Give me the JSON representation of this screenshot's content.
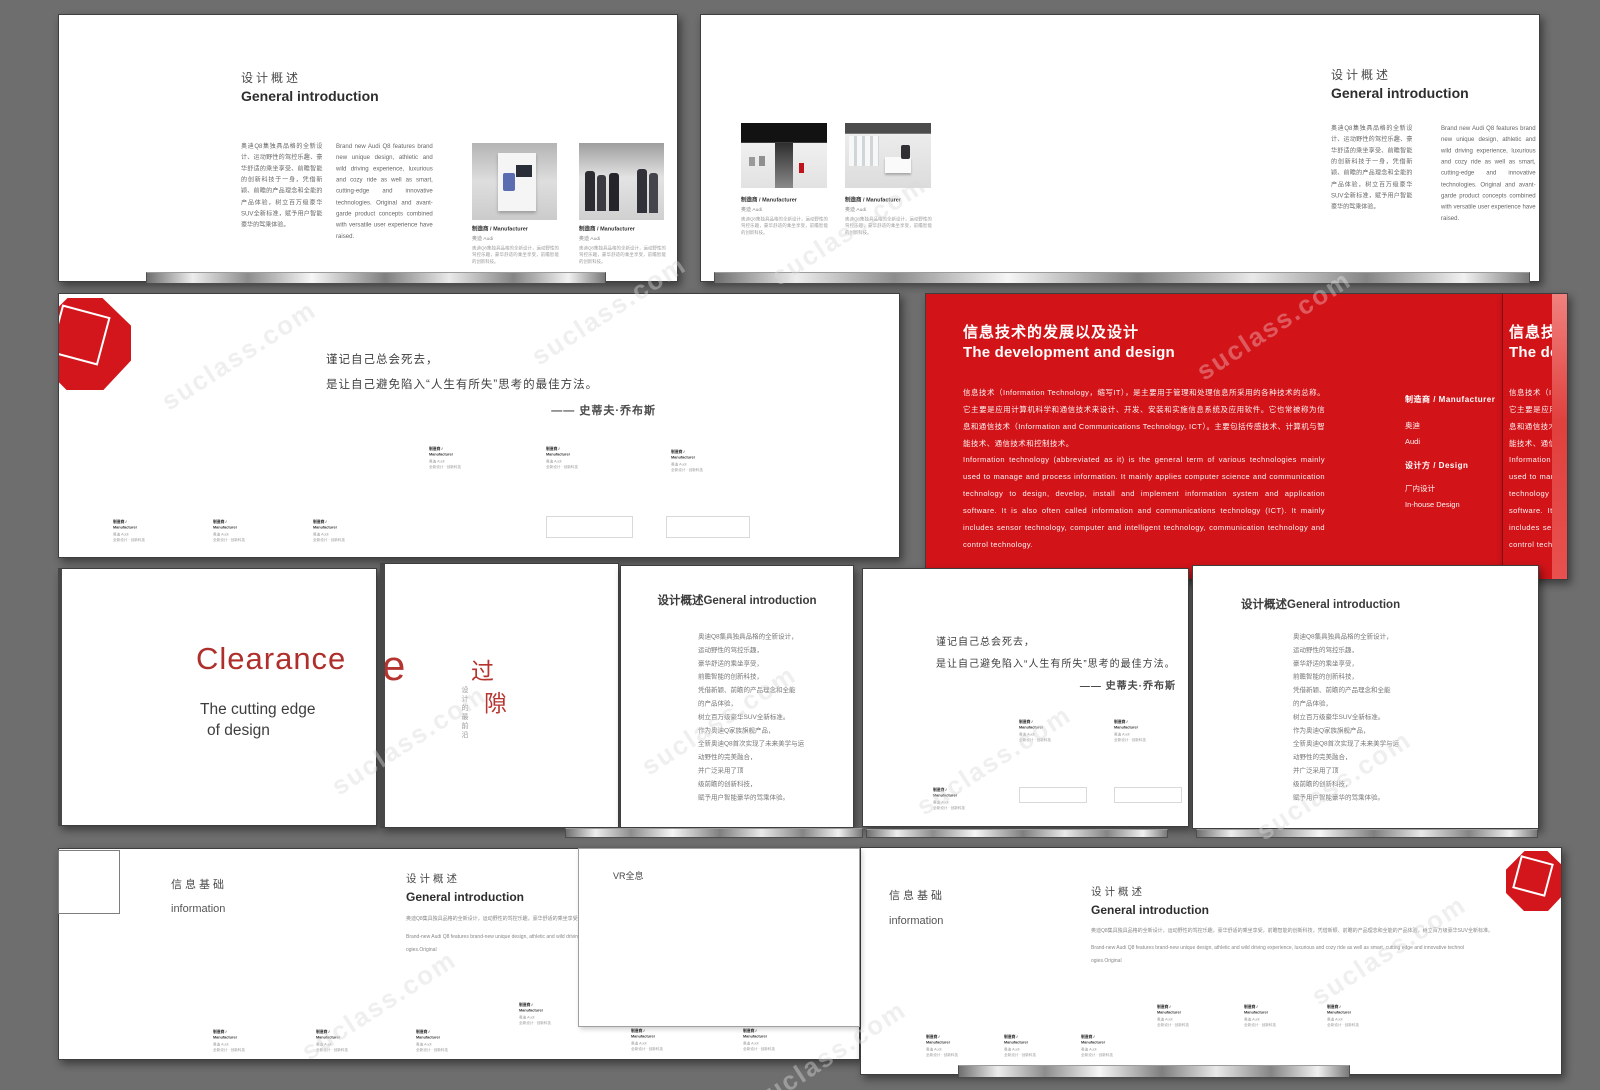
{
  "watermark": {
    "text": "suclass.com"
  },
  "colors": {
    "background": "#6e6e6e",
    "red": "#d21419",
    "cover_red": "#ae2f2b"
  },
  "shared": {
    "overview_zh": "设计概述",
    "overview_en": "General introduction",
    "info_zh": "信息基础",
    "info_en": "information",
    "quote": {
      "line1": "谨记自己总会死去，",
      "line2": "是让自己避免陷入“人生有所失”思考的最佳方法。",
      "attribution": "—— 史蒂夫·乔布斯"
    },
    "intro_para_zh": "奥迪Q8集独具品格的全新设计、运动野性的驾控乐趣、豪华舒适的乘坐享受、前瞻智能的创新科技于一身，凭借新颖、前瞻的产品理念和全能的产品体验，树立百万级豪华SUV全新标准，赋予用户智能豪华的驾乘体验。",
    "intro_para_en": "Brand new Audi Q8 features brand new unique design, athletic and wild driving experience, luxurious and cozy ride as well as smart, cutting-edge and innovative technologies. Original and avant-garde product concepts combined with versatile user experience have raised.",
    "photo_caption": {
      "title": "制造商 / Manufacturer",
      "subtitle": "奥迪 Audi",
      "body": "奥迪Q8集独具品格的全新设计，运动野性的驾控乐趣，豪华舒适的乘坐享受，前瞻智能的创新科技。"
    },
    "mini_caption": {
      "l1": "制造商 /",
      "l2": "Manufacturer",
      "l3": "奥迪 Audi",
      "l4": "全新设计 · 创新科技"
    },
    "intro_line_zh": "奥迪Q8集具独具品格的全新设计，运动野性的驾控乐趣，豪华舒适的乘坐享受，前瞻智能的创新科技，凭借新颖、前瞻的产品理念和全能的产品体验，树立百万级豪华SUV全新标准。",
    "intro_line_en1": "Brand-new Audi Q8 features brand-new unique design, athletic and wild driving experience, luxurious and cozy ride as well as smart, cutting edge and innovative technol",
    "intro_line_en2": "ogies.Original"
  },
  "red_slide": {
    "title_zh": "信息技术的发展以及设计",
    "title_en": "The development and design",
    "para_zh": "信息技术（Information Technology，缩写IT），是主要用于管理和处理信息所采用的各种技术的总称。它主要是应用计算机科学和通信技术来设计、开发、安装和实施信息系统及应用软件。它也常被称为信息和通信技术（Information and Communications Technology, ICT）。主要包括传感技术、计算机与智能技术、通信技术和控制技术。",
    "para_en": "Information technology (abbreviated as it) is the general term of various technologies mainly used to manage and process information. It mainly applies computer science and communication technology to design, develop, install and implement information system and application software. It is also often called information and communications technology (ICT). It mainly includes sensor technology, computer and intelligent technology, communication technology and control technology.",
    "manufacturer_label": "制造商 / Manufacturer",
    "manufacturer_zh": "奥迪",
    "manufacturer_en": "Audi",
    "design_label": "设计方 / Design",
    "design_zh": "厂内设计",
    "design_en": "In-house Design"
  },
  "cover": {
    "title": "Clearance",
    "subtitle1": "The cutting edge",
    "subtitle2": "of design"
  },
  "gap_slide": {
    "partial_letter": "e",
    "char1": "过",
    "char2": "隙",
    "vertical_sub": "设计的最前沿"
  },
  "overview_list": {
    "title": "设计概述General introduction",
    "lines": [
      "奥迪Q8集具独具品格的全新设计，",
      "运动野性的驾控乐趣，",
      "豪华舒适的乘坐享受，",
      "前瞻智能的创新科技，",
      "凭借新颖、前瞻的产品理念和全能",
      "的产品体验，",
      "树立百万级豪华SUV全新标准。",
      "作为奥迪Q家族旗舰产品，",
      "全新奥迪Q8首次实现了未来美学与运",
      "动野性的完美融合，",
      "并广泛采用了顶",
      "级前瞻的创新科技，",
      "赋予用户智能豪华的驾乘体验。"
    ]
  },
  "vr": {
    "title": "VR全息"
  }
}
